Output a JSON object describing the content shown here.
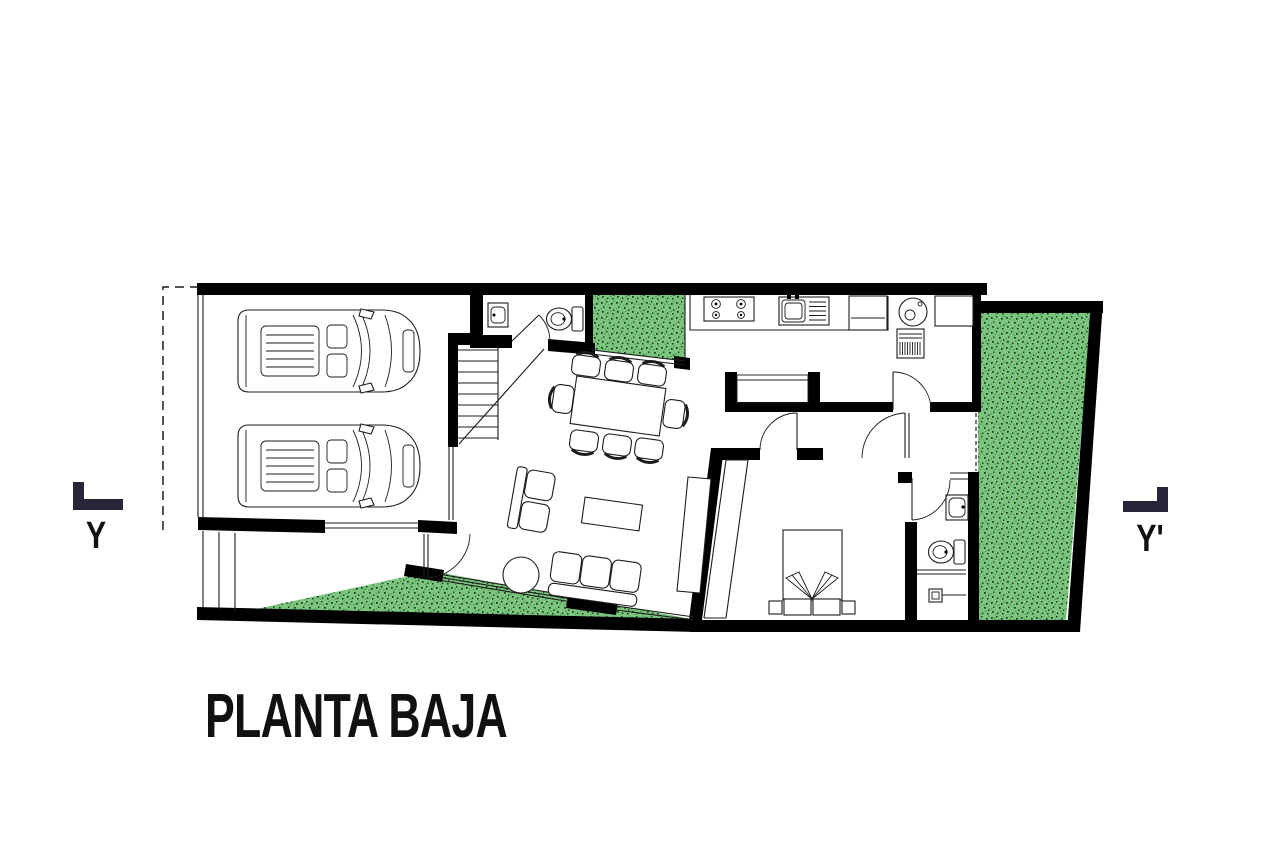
{
  "title": "PLANTA BAJA",
  "section_markers": {
    "left_label": "Y",
    "right_label": "Y'"
  },
  "colors": {
    "bg": "#ffffff",
    "wall": "#000000",
    "line": "#1c1c1c",
    "garden_green": "#7cc57e",
    "garden_speck_dark": "#16361a",
    "garden_speck_light": "#4f9c54",
    "marker_navy": "#2a2438"
  },
  "plan_elements": {
    "garage": [
      "car",
      "car"
    ],
    "staircase_steps": 8,
    "powder_room": [
      "sink",
      "toilet"
    ],
    "kitchen": [
      "stove-4-burner",
      "sink",
      "refrigerator"
    ],
    "laundry": [
      "washing-machine",
      "dryer",
      "counter"
    ],
    "dining": [
      "table",
      "8-chairs"
    ],
    "living": [
      "loveseat",
      "coffee-table",
      "round-side-table",
      "sofa",
      "tv-console"
    ],
    "bedroom": [
      "bed",
      "wardrobe"
    ],
    "bathroom": [
      "sink",
      "toilet",
      "shower"
    ],
    "gardens": [
      "courtyard",
      "side-garden",
      "front-garden"
    ]
  }
}
